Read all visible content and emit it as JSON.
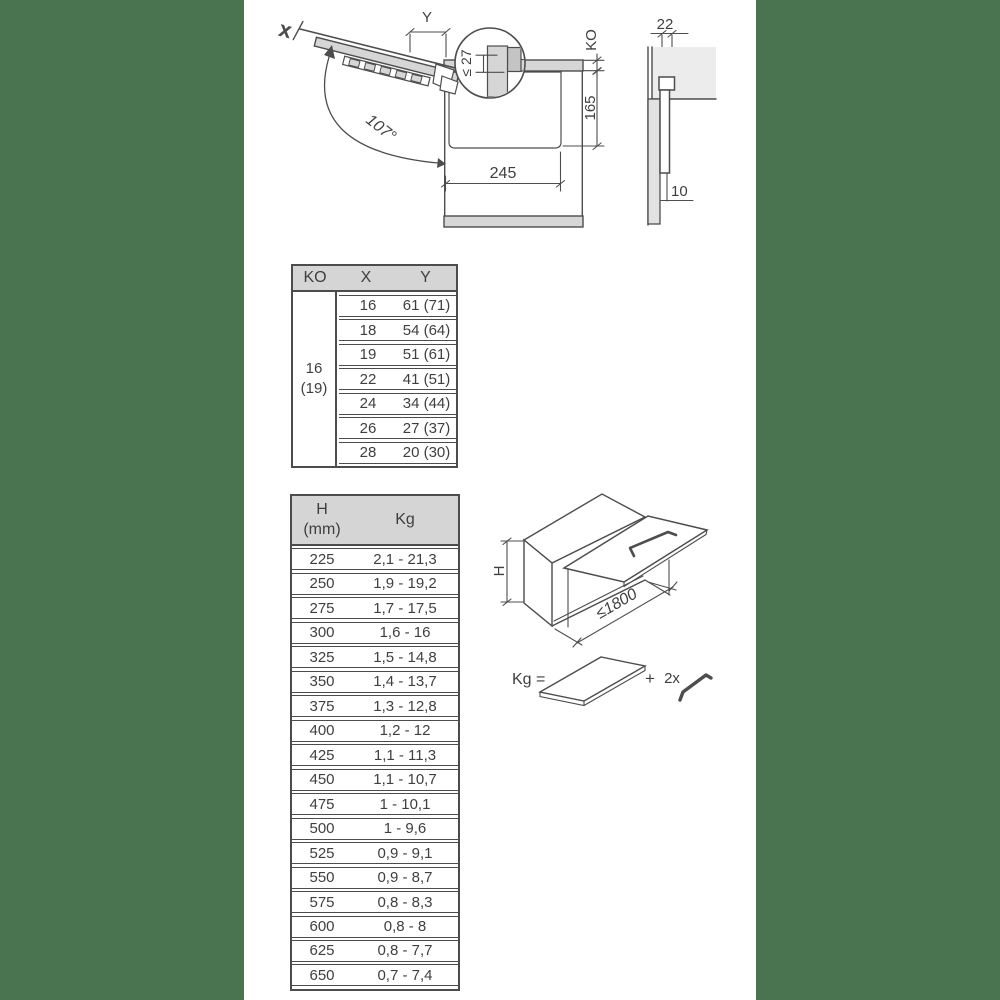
{
  "colors": {
    "background": "#4a7350",
    "line": "#4d4d4d",
    "panel_fill": "#d6d6d6",
    "light_fill": "#ececec",
    "table_header_fill": "#d5d5d6"
  },
  "side_view": {
    "x_label": "X",
    "y_label": "Y",
    "angle_label": "107°",
    "detail_label": "≤ 27",
    "ko_label": "KO",
    "height_label": "165",
    "depth_label": "245"
  },
  "section_view": {
    "top_label": "22",
    "bottom_label": "10"
  },
  "ko_table": {
    "header": {
      "ko": "KO",
      "x": "X",
      "y": "Y"
    },
    "merged_ko": {
      "line1": "16",
      "line2": "(19)"
    },
    "rows": [
      {
        "x": "16",
        "y": "61 (71)"
      },
      {
        "x": "18",
        "y": "54 (64)"
      },
      {
        "x": "19",
        "y": "51 (61)"
      },
      {
        "x": "22",
        "y": "41 (51)"
      },
      {
        "x": "24",
        "y": "34 (44)"
      },
      {
        "x": "26",
        "y": "27 (37)"
      },
      {
        "x": "28",
        "y": "20 (30)"
      }
    ]
  },
  "hkg_table": {
    "header": {
      "h_line1": "H",
      "h_line2": "(mm)",
      "kg": "Kg"
    },
    "rows": [
      {
        "h": "225",
        "kg": "2,1 - 21,3"
      },
      {
        "h": "250",
        "kg": "1,9 - 19,2"
      },
      {
        "h": "275",
        "kg": "1,7 - 17,5"
      },
      {
        "h": "300",
        "kg": "1,6 - 16"
      },
      {
        "h": "325",
        "kg": "1,5 - 14,8"
      },
      {
        "h": "350",
        "kg": "1,4 - 13,7"
      },
      {
        "h": "375",
        "kg": "1,3 - 12,8"
      },
      {
        "h": "400",
        "kg": "1,2 - 12"
      },
      {
        "h": "425",
        "kg": "1,1 - 11,3"
      },
      {
        "h": "450",
        "kg": "1,1 - 10,7"
      },
      {
        "h": "475",
        "kg": "1 - 10,1"
      },
      {
        "h": "500",
        "kg": "1 - 9,6"
      },
      {
        "h": "525",
        "kg": "0,9 - 9,1"
      },
      {
        "h": "550",
        "kg": "0,9 - 8,7"
      },
      {
        "h": "575",
        "kg": "0,8 - 8,3"
      },
      {
        "h": "600",
        "kg": "0,8 - 8"
      },
      {
        "h": "625",
        "kg": "0,8 - 7,7"
      },
      {
        "h": "650",
        "kg": "0,7 - 7,4"
      }
    ]
  },
  "isometric": {
    "height_label": "H",
    "width_label": "≤1800"
  },
  "formula": {
    "kg_label": "Kg =",
    "plus_sign": "+",
    "multiplier_label": "2x"
  }
}
